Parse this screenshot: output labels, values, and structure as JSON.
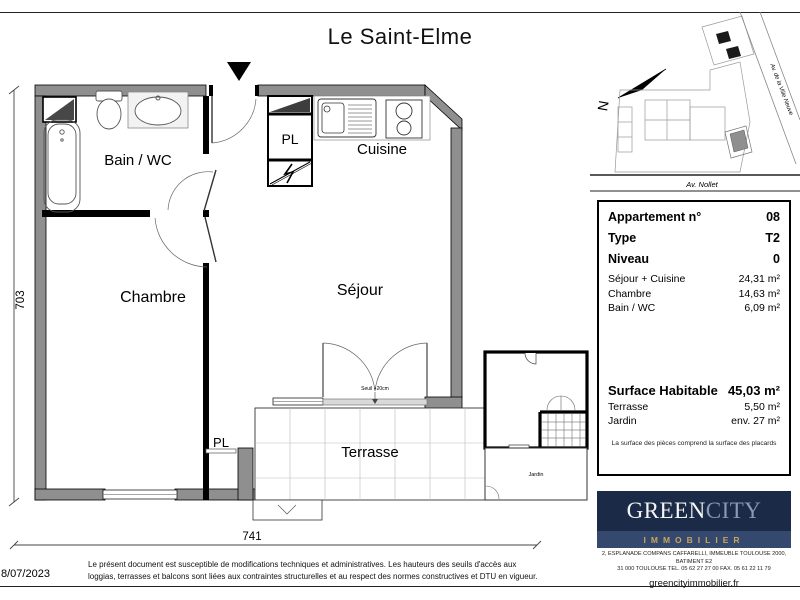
{
  "title": "Le Saint-Elme",
  "date": "8/07/2023",
  "disclaimer_lines": [
    "Le présent document est susceptible de modifications techniques et administratives. Les hauteurs des seuils d'accès aux",
    "loggias, terrasses et balcons sont liées aux contraintes structurelles et au respect des normes constructives et DTU en vigueur."
  ],
  "floorplan": {
    "rooms": {
      "bain": "Bain / WC",
      "cuisine": "Cuisine",
      "pl_entrance": "PL",
      "chambre": "Chambre",
      "sejour": "Séjour",
      "pl_bottom": "PL",
      "terrasse": "Terrasse",
      "jardin": "Jardin"
    },
    "threshold": "Seuil +20cm",
    "dim_width": "741",
    "dim_height": "703"
  },
  "sitemap": {
    "north_letter": "N",
    "street_diagonal": "Av. de la Ville Neuve",
    "street_bottom": "Av. Nollet"
  },
  "info": {
    "apartment_label": "Appartement n°",
    "apartment_value": "08",
    "type_label": "Type",
    "type_value": "T2",
    "level_label": "Niveau",
    "level_value": "0",
    "areas": [
      {
        "label": "Séjour + Cuisine",
        "value": "24,31 m²"
      },
      {
        "label": "Chambre",
        "value": "14,63 m²"
      },
      {
        "label": "Bain / WC",
        "value": "6,09 m²"
      }
    ],
    "surface_label": "Surface Habitable",
    "surface_value": "45,03 m²",
    "extras": [
      {
        "label": "Terrasse",
        "value": "5,50 m²"
      },
      {
        "label": "Jardin",
        "value": "env. 27 m²"
      }
    ],
    "note": "La surface des pièces comprend la surface des placards"
  },
  "logo": {
    "green": "GREEN",
    "city": "CITY",
    "band": "IMMOBILIER",
    "address_lines": [
      "2, ESPLANADE COMPANS CAFFARELLI, IMMEUBLE TOULOUSE 2000, BATIMENT E2",
      "31 000 TOULOUSE  TEL. 05 62 27 27 00 FAX. 05 61 22 11 79"
    ],
    "website": "greencityimmobilier.fr"
  },
  "colors": {
    "wall_gray": "#8f8f8f",
    "logo_navy": "#1b2a47",
    "logo_band": "#34496d",
    "logo_gold": "#c9a45f"
  }
}
